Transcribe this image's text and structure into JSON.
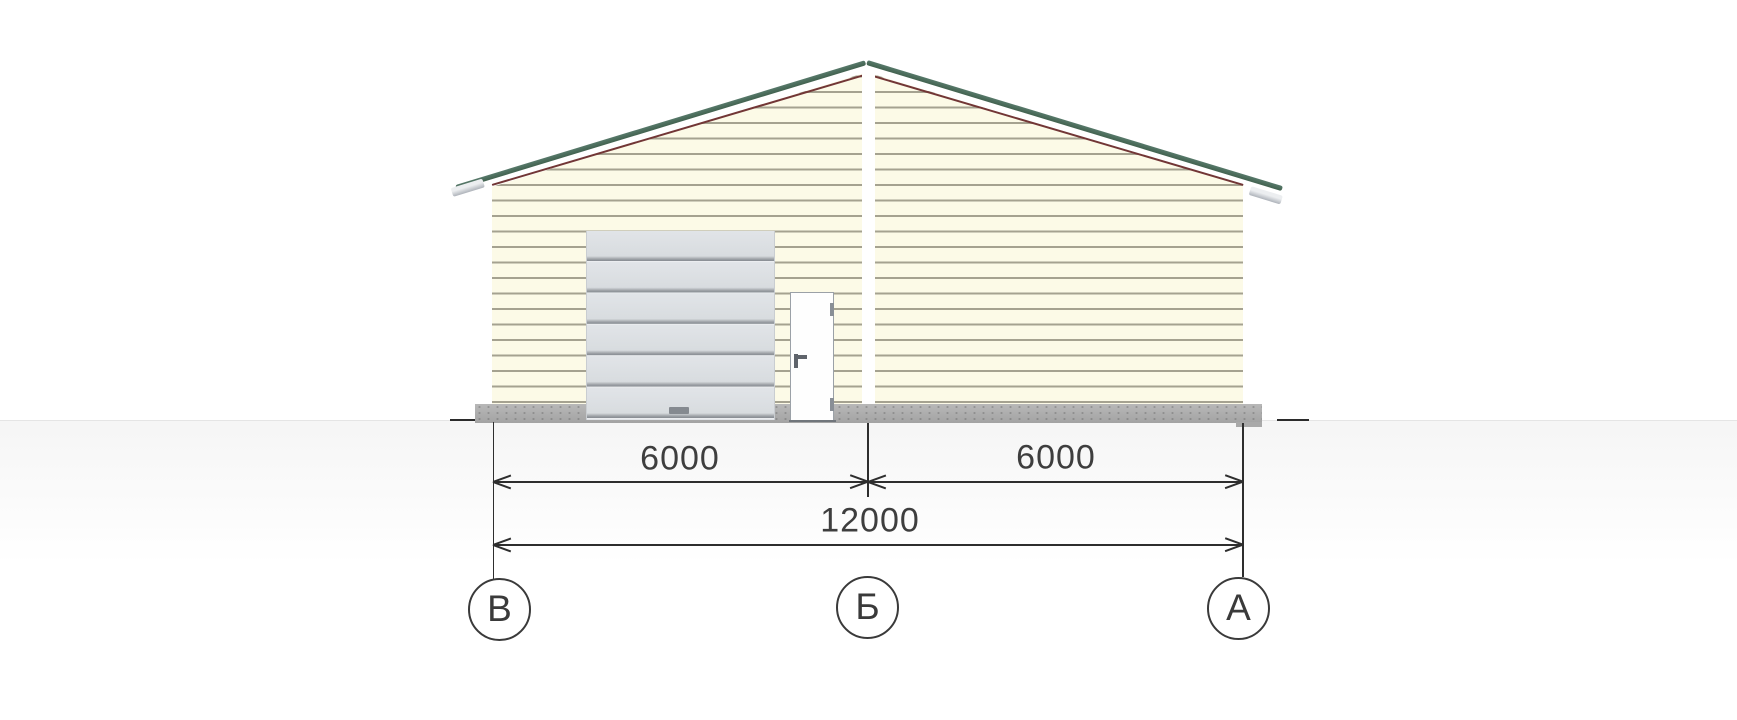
{
  "drawing": {
    "type": "architectural-elevation",
    "view": "building-facade"
  },
  "dimension_labels": {
    "left_span": "6000",
    "right_span": "6000",
    "total_span": "12000"
  },
  "axis_markers": [
    {
      "label": "В"
    },
    {
      "label": "Б"
    },
    {
      "label": "А"
    }
  ],
  "colors": {
    "roof_edge_green": "#4d6e5c",
    "fascia_maroon": "#723636",
    "siding_cream": "#fcfae7",
    "siding_line": "#a5a290",
    "garage_door_gray": "#dde0e4",
    "entry_door_white": "#fefefe",
    "foundation_gray": "#aeaeae",
    "dimension_ink": "#2e2e2e"
  }
}
